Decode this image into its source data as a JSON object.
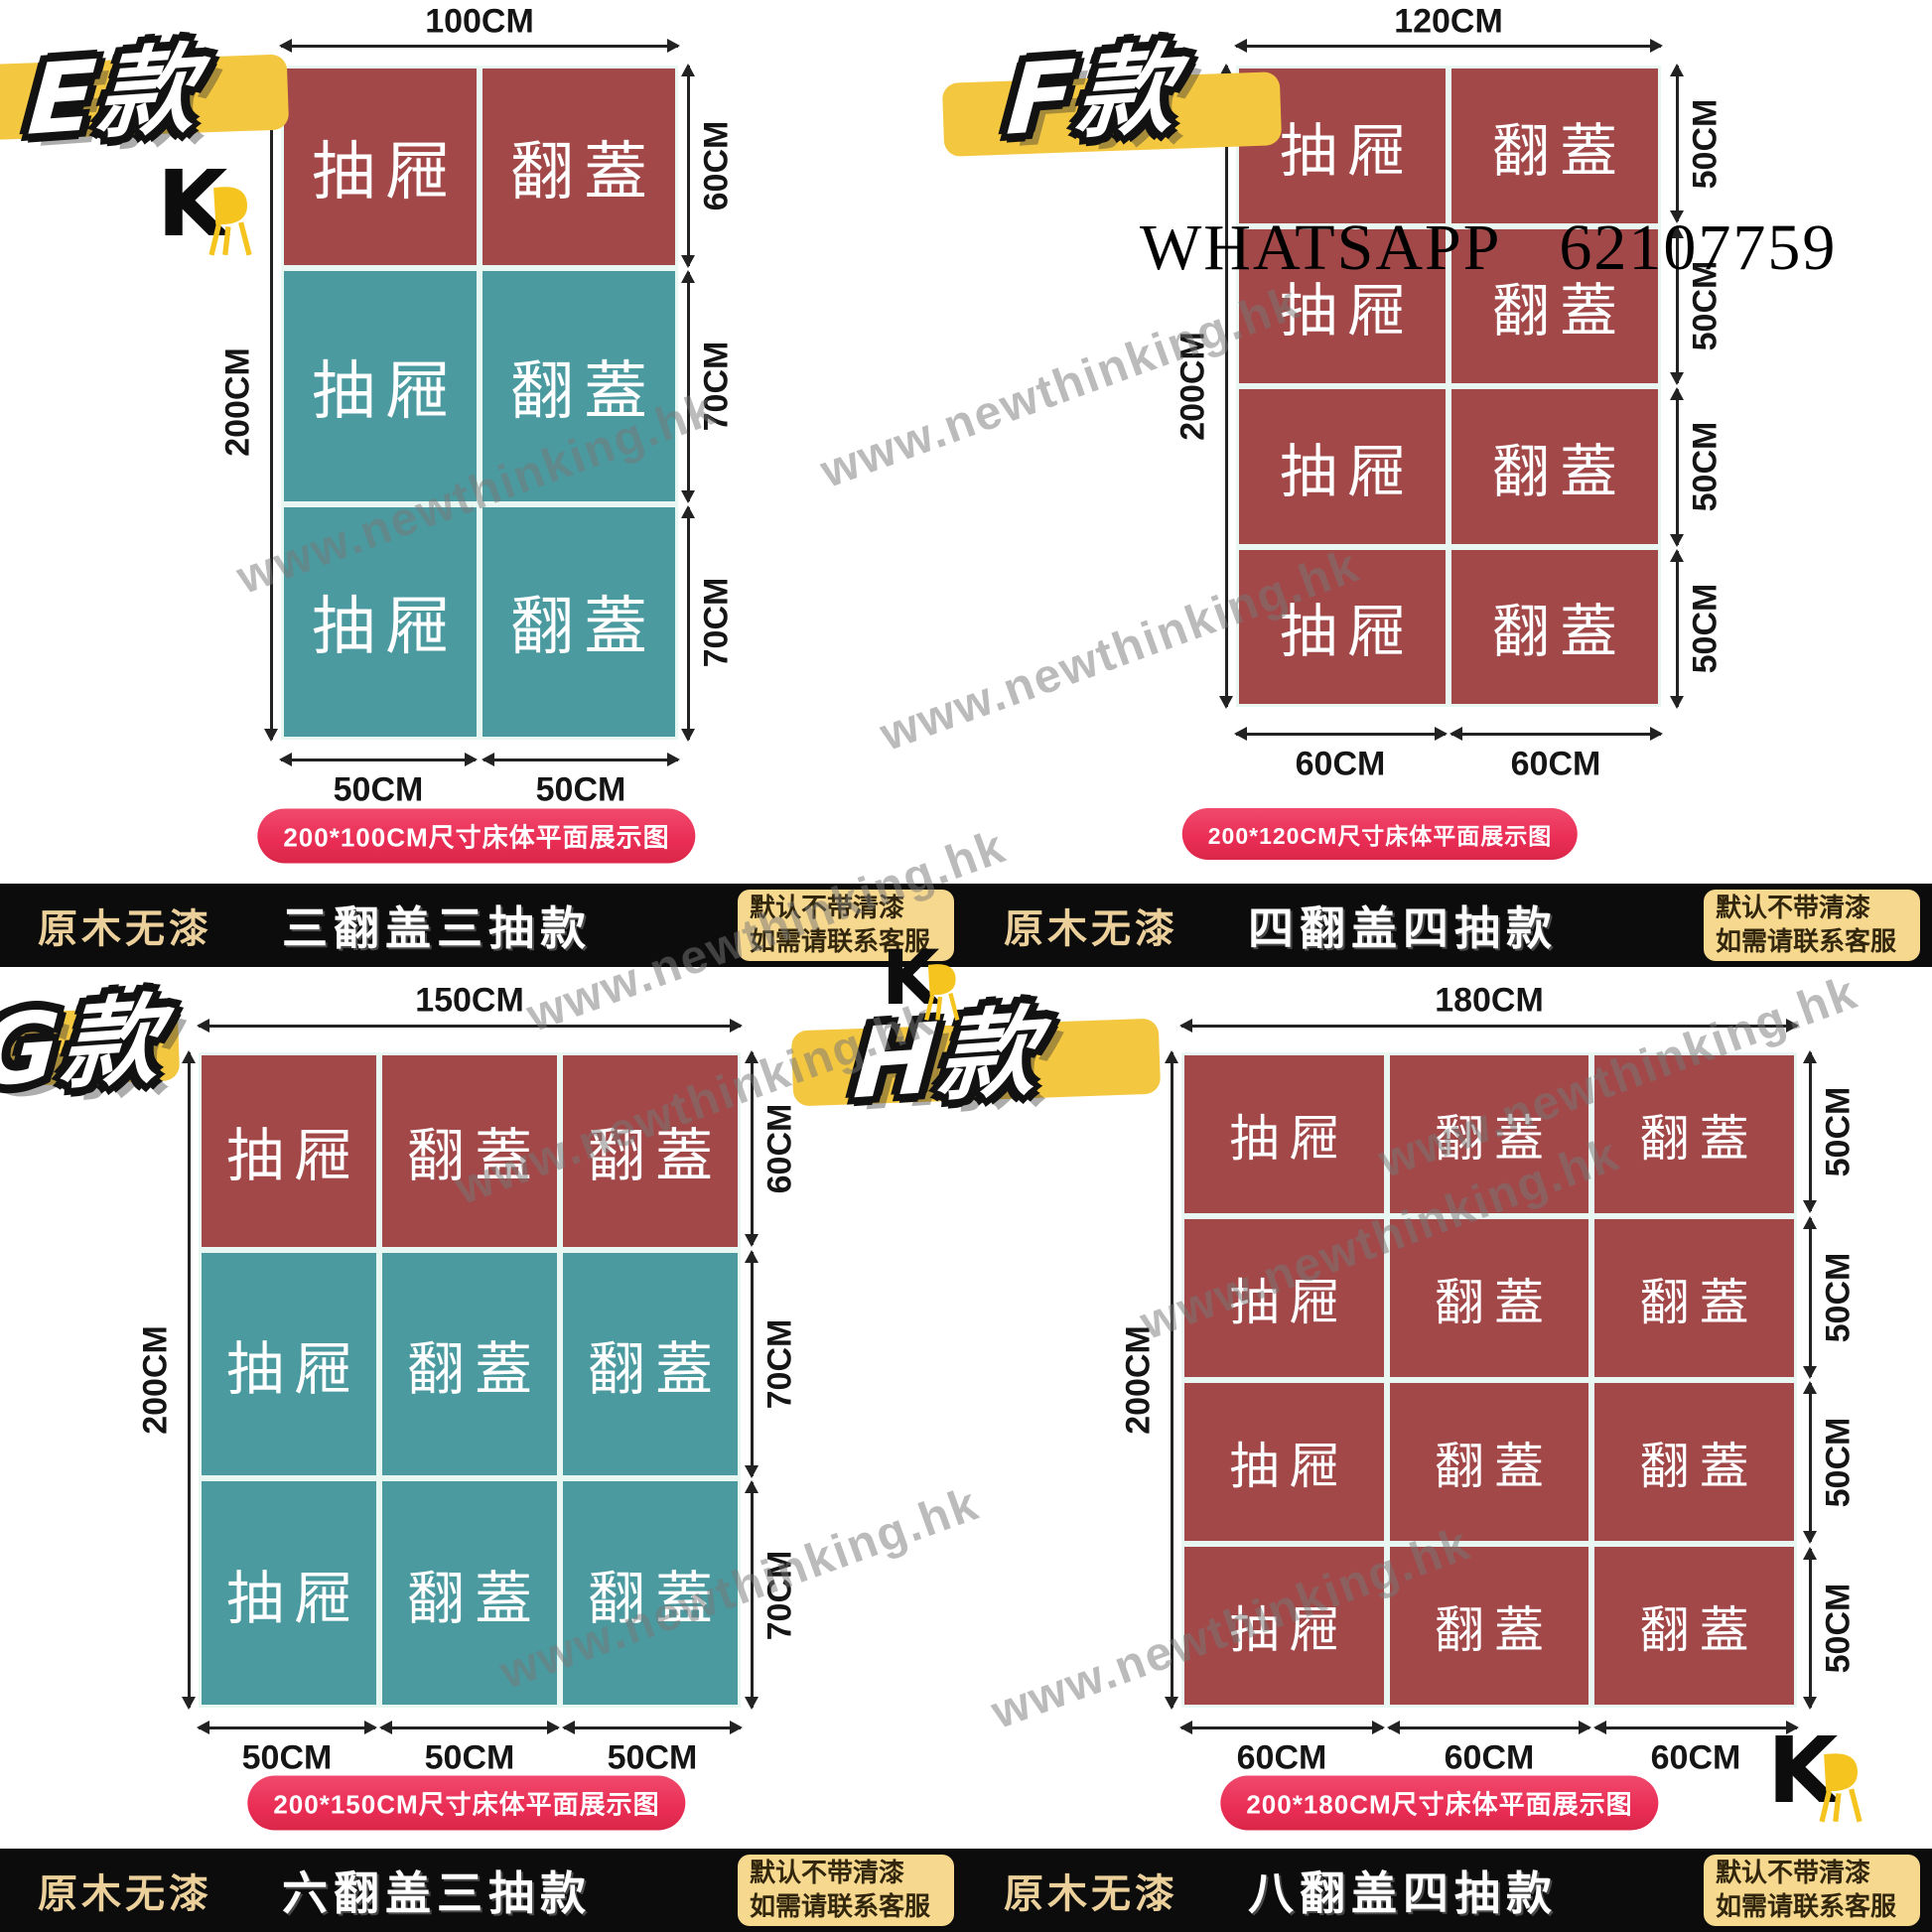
{
  "watermark": {
    "text": "www.newthinking.hk"
  },
  "contact": {
    "app": "WHATSAPP",
    "number": "62107759"
  },
  "brand": {
    "letter": "K"
  },
  "colors": {
    "drawer_red": "#a24849",
    "flip_teal": "#4a9aa0",
    "caption_pink": "#ee3157",
    "highlight_yellow": "#f4c740",
    "strip_black": "#0c0c0c",
    "badge_yellow": "#f6d88e",
    "strip_tag_gold": "#ecd09b"
  },
  "panels": {
    "e": {
      "label": "E款",
      "top_dim": "100CM",
      "left_dim": "200CM",
      "right_dims": [
        "60CM",
        "70CM",
        "70CM"
      ],
      "bottom_dims": [
        "50CM",
        "50CM"
      ],
      "caption": "200*100CM尺寸床体平面展示图",
      "rows": [
        {
          "cells": [
            "抽屜",
            "翻蓋"
          ]
        },
        {
          "cells": [
            "抽屜",
            "翻蓋"
          ]
        },
        {
          "cells": [
            "抽屜",
            "翻蓋"
          ]
        }
      ]
    },
    "f": {
      "label": "F款",
      "top_dim": "120CM",
      "left_dim": "200CM",
      "right_dims": [
        "50CM",
        "50CM",
        "50CM",
        "50CM"
      ],
      "bottom_dims": [
        "60CM",
        "60CM"
      ],
      "caption": "200*120CM尺寸床体平面展示图",
      "rows": [
        {
          "cells": [
            "抽屜",
            "翻蓋"
          ]
        },
        {
          "cells": [
            "抽屜",
            "翻蓋"
          ]
        },
        {
          "cells": [
            "抽屜",
            "翻蓋"
          ]
        },
        {
          "cells": [
            "抽屜",
            "翻蓋"
          ]
        }
      ]
    },
    "g": {
      "label": "G款",
      "top_dim": "150CM",
      "left_dim": "200CM",
      "right_dims": [
        "60CM",
        "70CM",
        "70CM"
      ],
      "bottom_dims": [
        "50CM",
        "50CM",
        "50CM"
      ],
      "caption": "200*150CM尺寸床体平面展示图",
      "rows": [
        {
          "cells": [
            "抽屜",
            "翻蓋",
            "翻蓋"
          ]
        },
        {
          "cells": [
            "抽屜",
            "翻蓋",
            "翻蓋"
          ]
        },
        {
          "cells": [
            "抽屜",
            "翻蓋",
            "翻蓋"
          ]
        }
      ]
    },
    "h": {
      "label": "H款",
      "top_dim": "180CM",
      "left_dim": "200CM",
      "right_dims": [
        "50CM",
        "50CM",
        "50CM",
        "50CM"
      ],
      "bottom_dims": [
        "60CM",
        "60CM",
        "60CM"
      ],
      "caption": "200*180CM尺寸床体平面展示图",
      "rows": [
        {
          "cells": [
            "抽屜",
            "翻蓋",
            "翻蓋"
          ]
        },
        {
          "cells": [
            "抽屜",
            "翻蓋",
            "翻蓋"
          ]
        },
        {
          "cells": [
            "抽屜",
            "翻蓋",
            "翻蓋"
          ]
        },
        {
          "cells": [
            "抽屜",
            "翻蓋",
            "翻蓋"
          ]
        }
      ]
    }
  },
  "strips": [
    {
      "left": {
        "tag": "原木无漆",
        "title": "三翻盖三抽款",
        "badge_line1": "默认不带清漆",
        "badge_line2": "如需请联系客服"
      },
      "right": {
        "tag": "原木无漆",
        "title": "四翻盖四抽款",
        "badge_line1": "默认不带清漆",
        "badge_line2": "如需请联系客服"
      }
    },
    {
      "left": {
        "tag": "原木无漆",
        "title": "六翻盖三抽款",
        "badge_line1": "默认不带清漆",
        "badge_line2": "如需请联系客服"
      },
      "right": {
        "tag": "原木无漆",
        "title": "八翻盖四抽款",
        "badge_line1": "默认不带清漆",
        "badge_line2": "如需请联系客服"
      }
    }
  ]
}
